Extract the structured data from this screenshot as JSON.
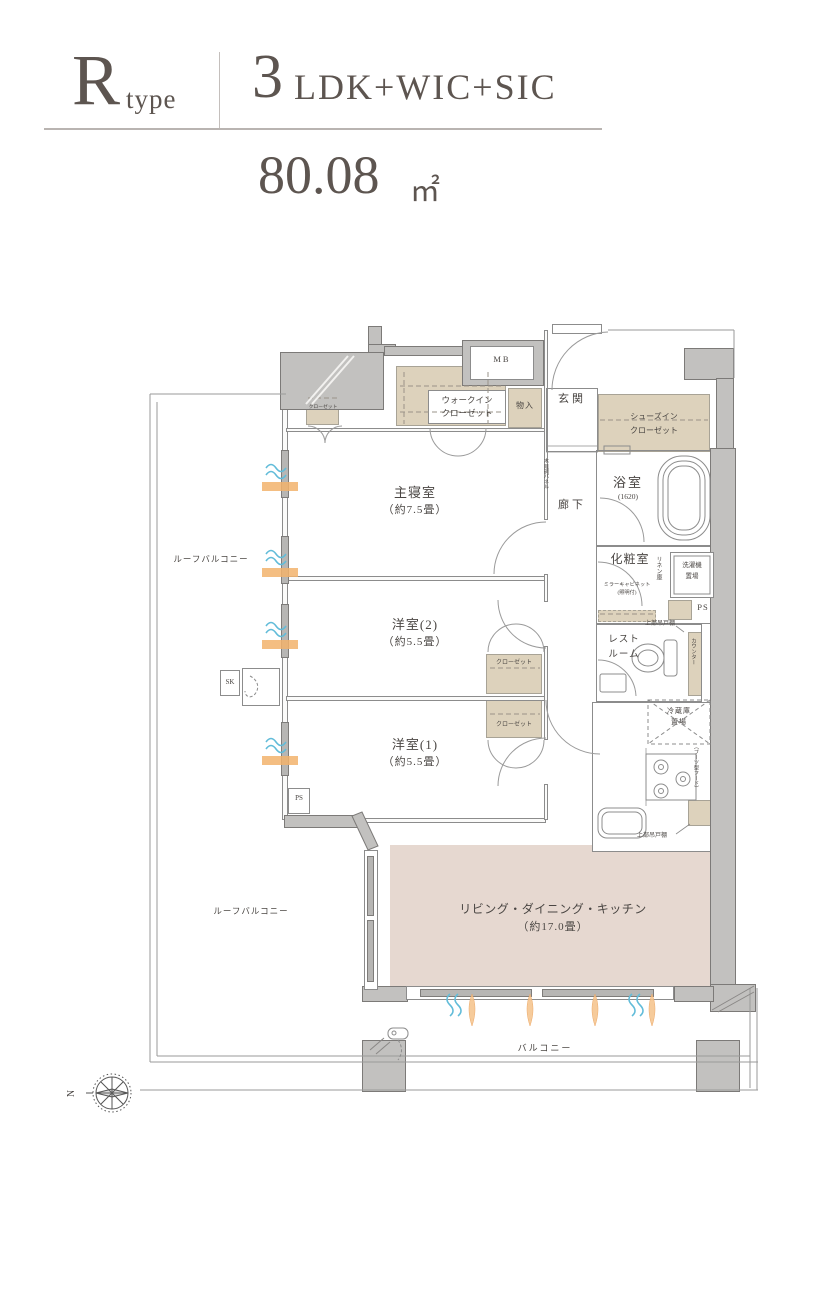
{
  "header": {
    "type_letter": "R",
    "type_word": "type",
    "plan_number": "3",
    "plan_text": "LDK+WIC+SIC",
    "area_value": "80.08",
    "area_unit": "㎡"
  },
  "rooms": {
    "master_name": "主寝室",
    "master_size": "（約7.5畳）",
    "west2_name": "洋室(2)",
    "west2_size": "（約5.5畳）",
    "west1_name": "洋室(1)",
    "west1_size": "（約5.5畳）",
    "ldk_name": "リビング・ダイニング・キッチン",
    "ldk_size": "（約17.0畳）",
    "bath_name": "浴室",
    "bath_size": "(1620)",
    "powder_name": "化粧室",
    "restroom_name": "レスト\nルーム",
    "entrance_name": "玄関",
    "hallway_name": "廊下"
  },
  "storage": {
    "wic": "ウォークイン\nクローゼット",
    "sic": "シューズイン\nクローゼット",
    "closet": "クローゼット",
    "monoire": "物入",
    "linen": "リネン庫",
    "washer": "洗濯機\n置場",
    "fridge": "冷蔵庫\n置場",
    "counter": "カウンター",
    "hanging": "上部吊戸棚",
    "mirror": "ミラーキャビネット\n(照明付)",
    "hood": "（ブーツ型フード）",
    "panel": "木目調パネル"
  },
  "labels": {
    "mb": "MB",
    "ps": "PS",
    "sk": "SK",
    "north": "N"
  },
  "balcony": {
    "balcony": "バルコニー",
    "roof": "ルーフバルコニー"
  },
  "colors": {
    "wall": "#c2c1bf",
    "closet_fill": "#ddd2bc",
    "ldk_fill": "#e6d8d0",
    "wave_blue": "#62bcd9",
    "light_orange": "#f2b36c"
  }
}
